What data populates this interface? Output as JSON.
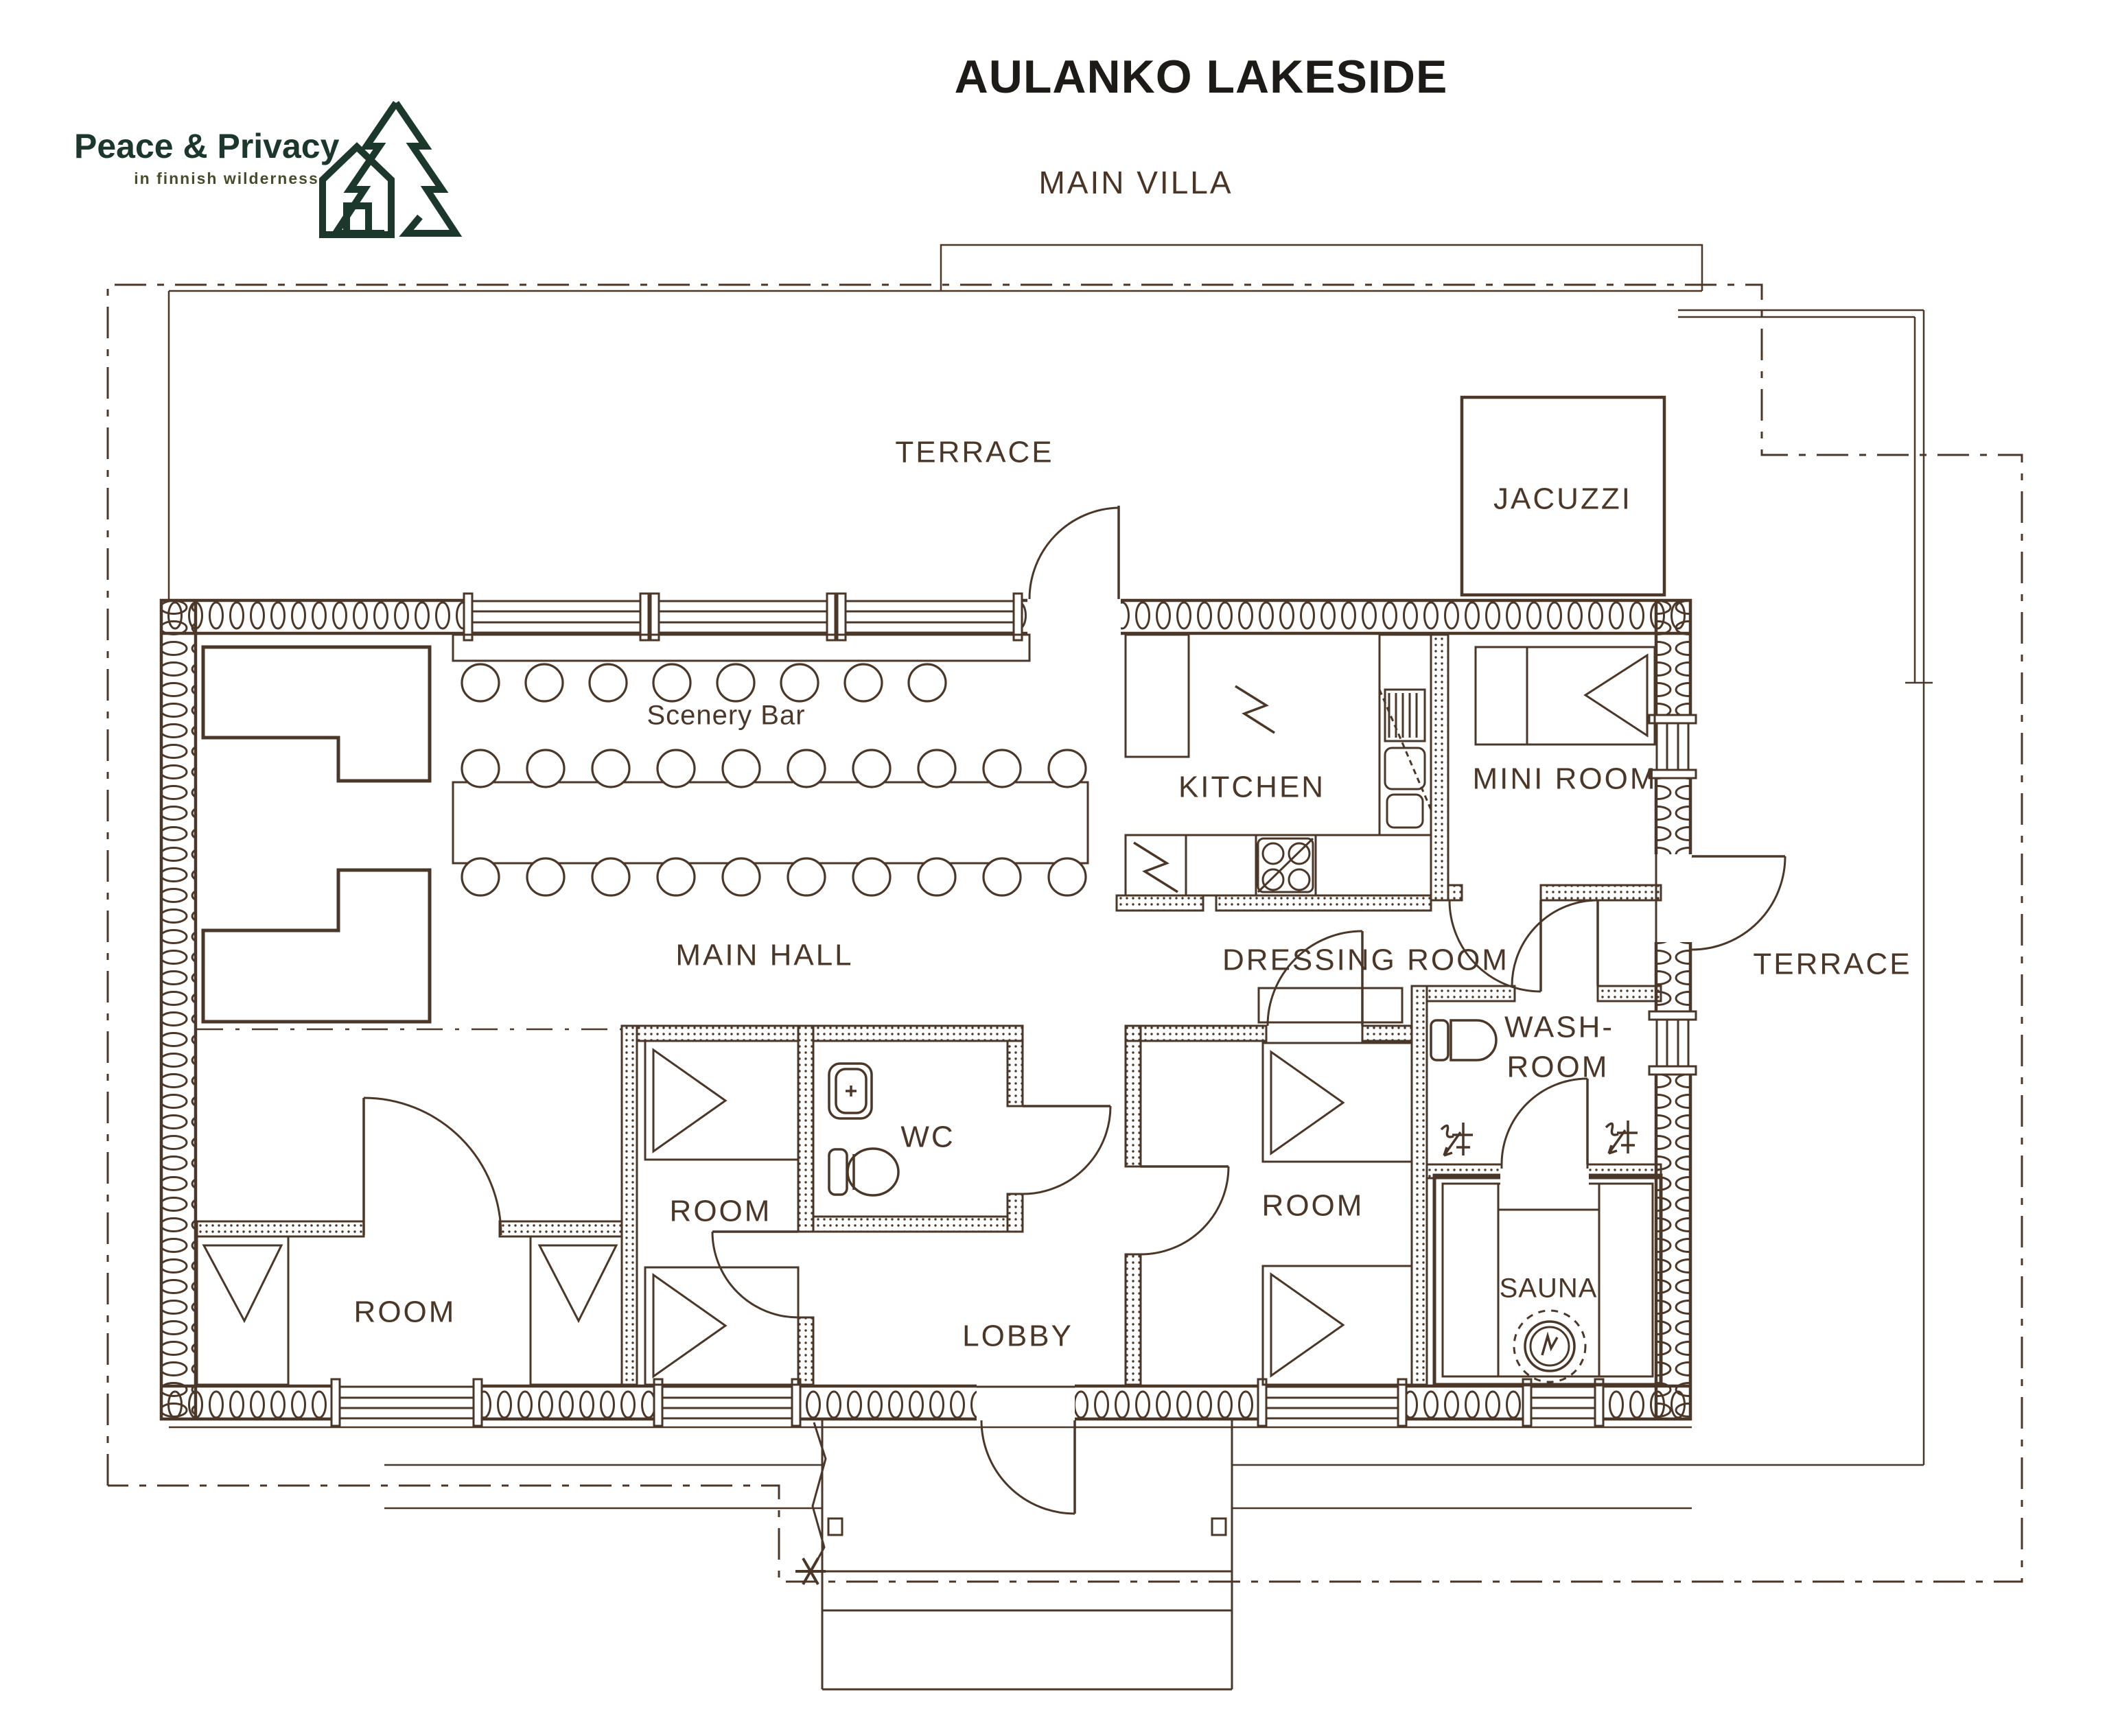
{
  "logo": {
    "title": "Peace & Privacy",
    "subtitle": "in finnish wilderness"
  },
  "header": {
    "title": "AULANKO LAKESIDE",
    "subtitle": "MAIN VILLA"
  },
  "rooms": {
    "terrace_top": "TERRACE",
    "jacuzzi": "JACUZZI",
    "scenery_bar": "Scenery Bar",
    "kitchen": "KITCHEN",
    "mini_room": "MINI ROOM",
    "main_hall": "MAIN HALL",
    "dressing_room": "DRESSING ROOM",
    "terrace_right": "TERRACE",
    "washroom_line1": "WASH-",
    "washroom_line2": "ROOM",
    "wc": "WC",
    "room_left": "ROOM",
    "room_center": "ROOM",
    "room_right": "ROOM",
    "lobby": "LOBBY",
    "sauna": "SAUNA"
  },
  "colors": {
    "line": "#4a3728",
    "title": "#1d1b18",
    "villa": "#4a3425",
    "logo_green": "#1c382c"
  }
}
